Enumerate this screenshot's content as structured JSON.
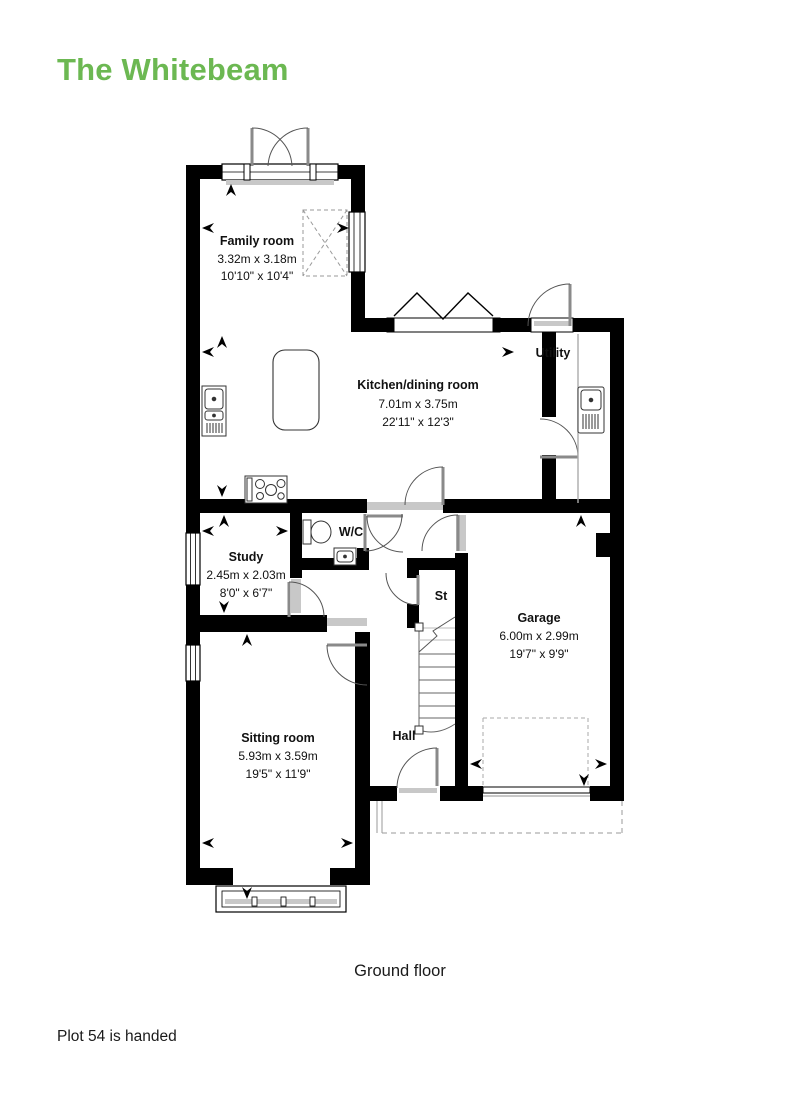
{
  "title": "The Whitebeam",
  "floor_caption": "Ground floor",
  "footnote": "Plot 54 is handed",
  "colors": {
    "accent_green": "#6cb852",
    "wall_black": "#000000",
    "door_gray": "#8a8a8a",
    "sill_gray": "#c8c8c8",
    "dash_gray": "#9a9a9a"
  },
  "rooms": {
    "family_room": {
      "name": "Family room",
      "metric": "3.32m x 3.18m",
      "imperial": "10'10\" x 10'4\""
    },
    "kitchen_dining": {
      "name": "Kitchen/dining room",
      "metric": "7.01m x 3.75m",
      "imperial": "22'11\" x 12'3\""
    },
    "utility": {
      "name": "Utility"
    },
    "study": {
      "name": "Study",
      "metric": "2.45m x 2.03m",
      "imperial": "8'0\" x 6'7\""
    },
    "wc": {
      "name": "W/C"
    },
    "store": {
      "name": "St"
    },
    "garage": {
      "name": "Garage",
      "metric": "6.00m x 2.99m",
      "imperial": "19'7\" x 9'9\""
    },
    "sitting_room": {
      "name": "Sitting room",
      "metric": "5.93m x 3.59m",
      "imperial": "19'5\" x 11'9\""
    },
    "hall": {
      "name": "Hall"
    }
  },
  "plan_icons": [
    "kitchen-sink",
    "hob",
    "kitchen-island",
    "utility-sink",
    "toilet",
    "wash-basin",
    "stairs",
    "bay-window",
    "rooflight",
    "dimension-arrow"
  ]
}
